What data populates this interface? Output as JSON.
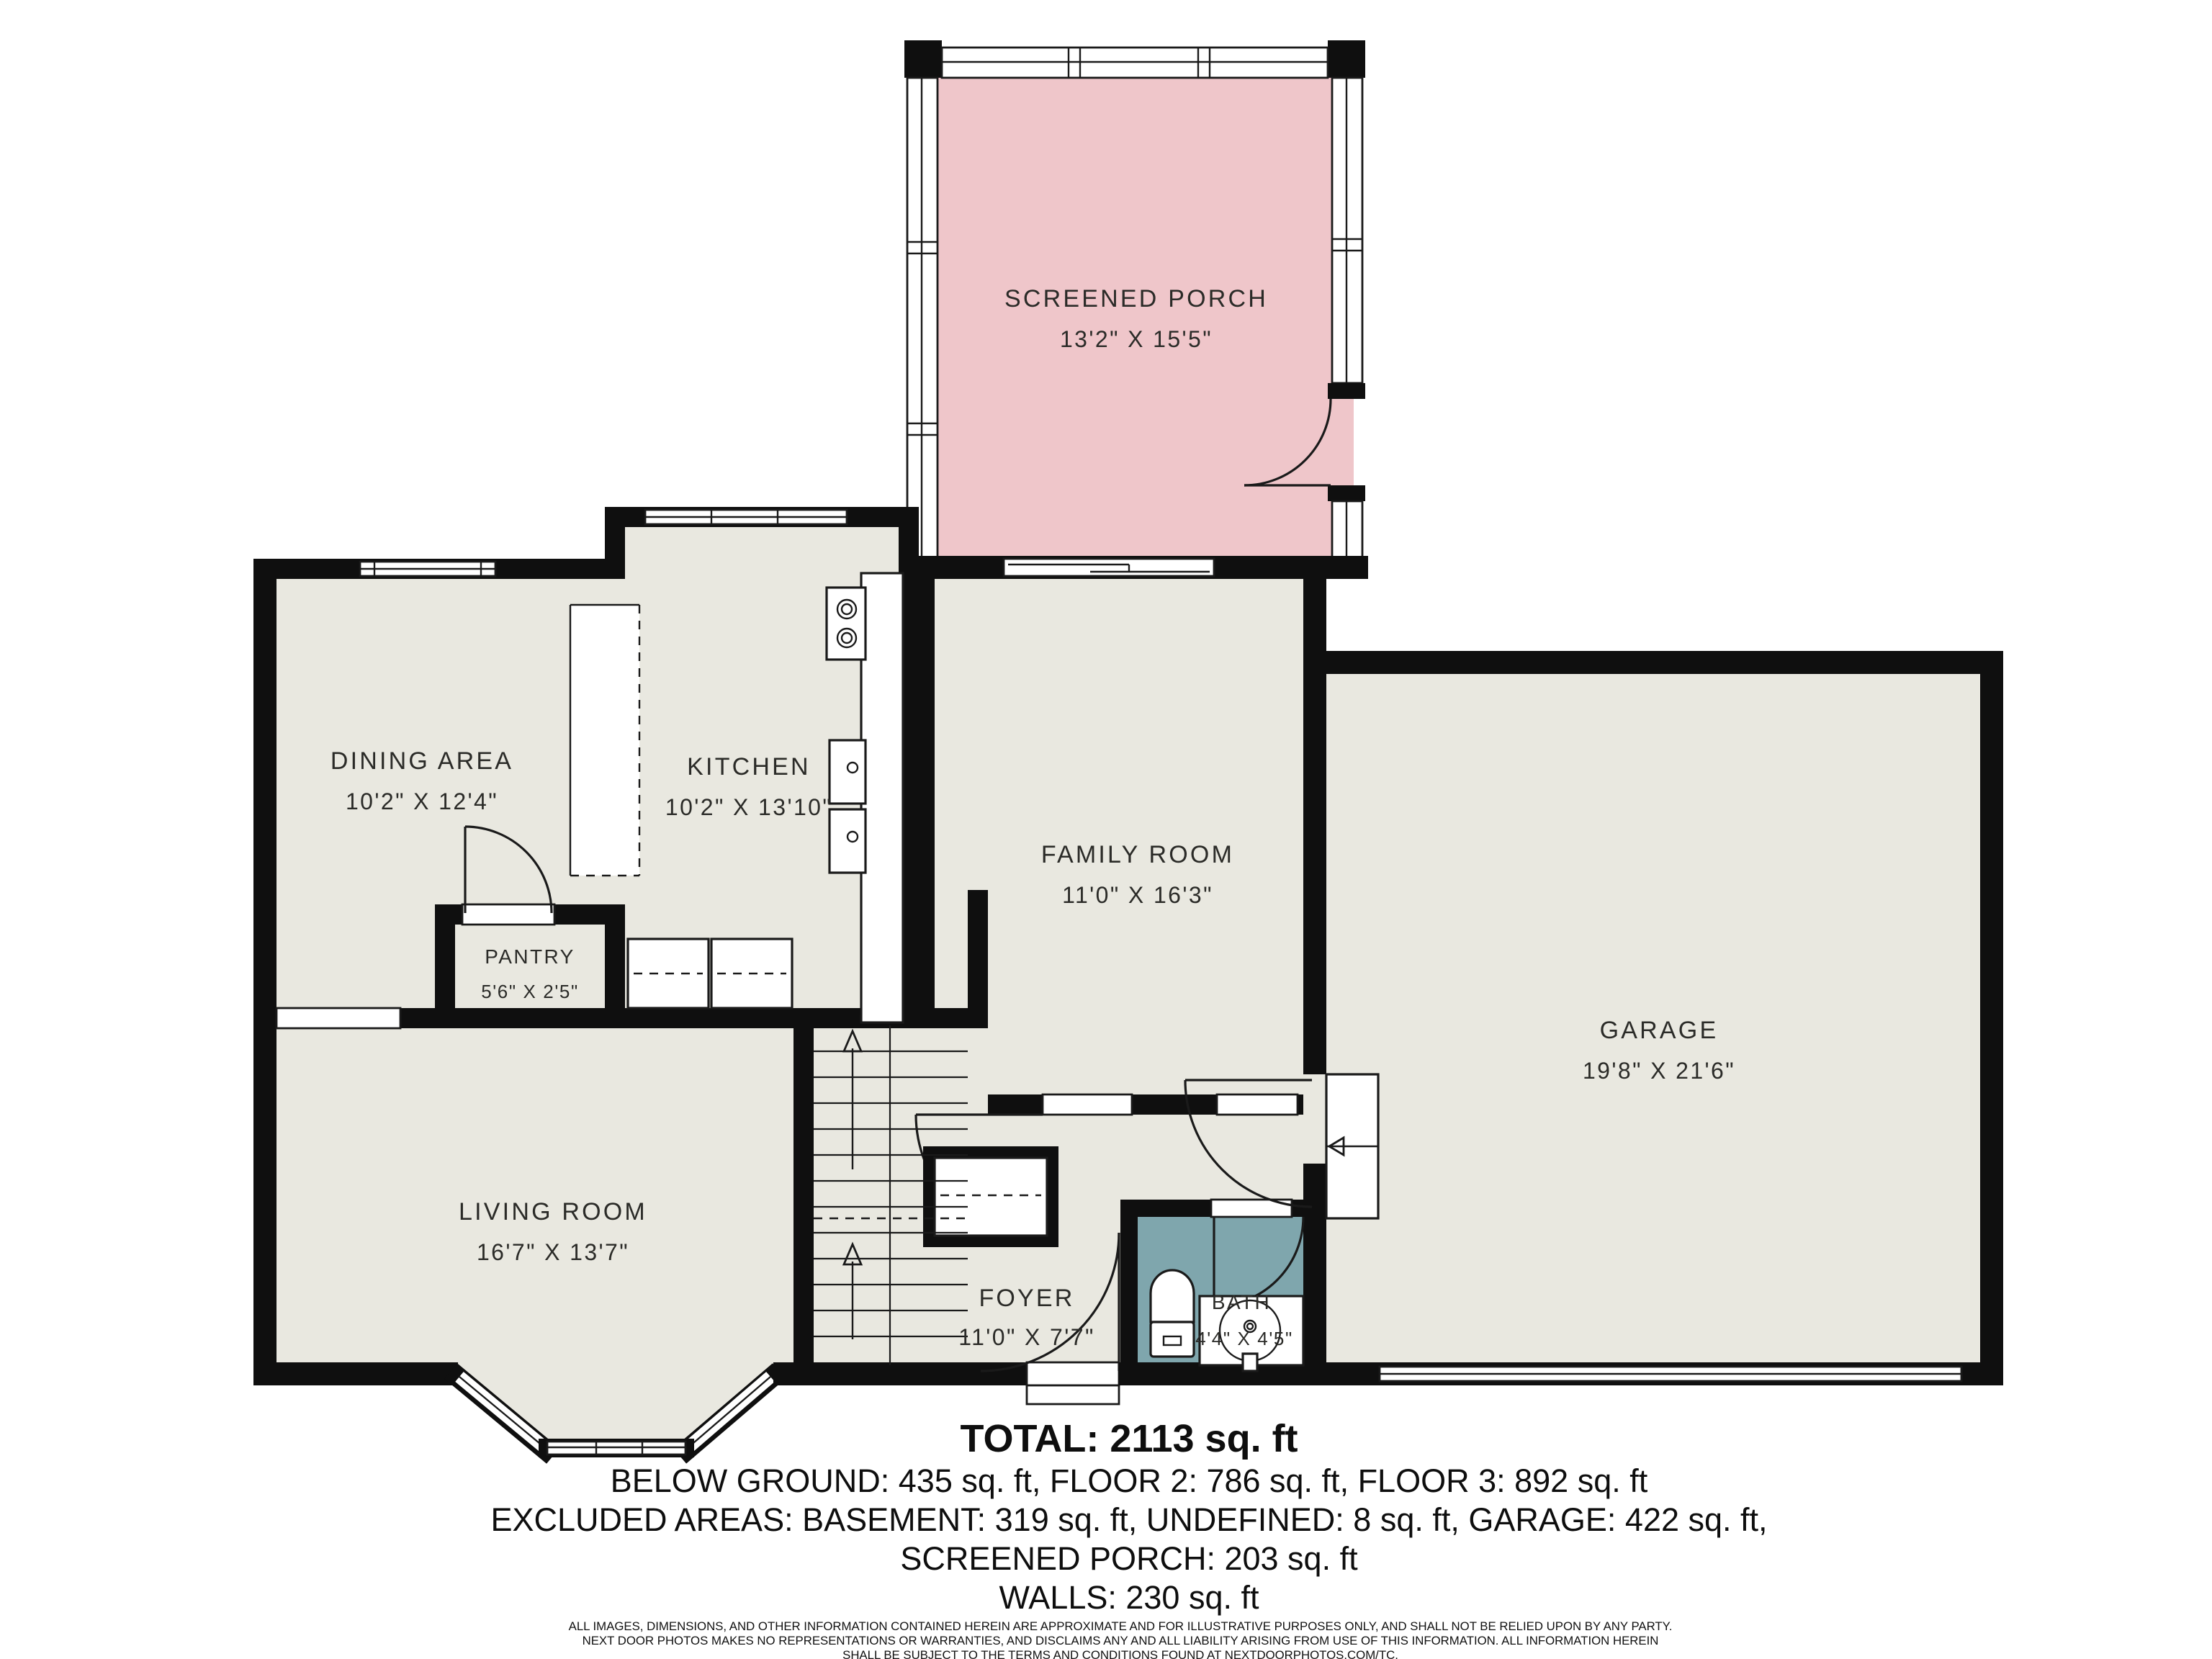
{
  "plan": {
    "type": "floor-plan",
    "rooms": [
      {
        "id": "screened_porch",
        "name": "SCREENED PORCH",
        "dims": "13'2\" X 15'5\""
      },
      {
        "id": "dining_area",
        "name": "DINING AREA",
        "dims": "10'2\" X 12'4\""
      },
      {
        "id": "kitchen",
        "name": "KITCHEN",
        "dims": "10'2\" X 13'10\""
      },
      {
        "id": "family_room",
        "name": "FAMILY ROOM",
        "dims": "11'0\" X 16'3\""
      },
      {
        "id": "pantry",
        "name": "PANTRY",
        "dims": "5'6\" X 2'5\""
      },
      {
        "id": "living_room",
        "name": "LIVING ROOM",
        "dims": "16'7\" X 13'7\""
      },
      {
        "id": "foyer",
        "name": "FOYER",
        "dims": "11'0\" X 7'7\""
      },
      {
        "id": "bath",
        "name": "BATH",
        "dims": "4'4\" X 4'5\""
      },
      {
        "id": "garage",
        "name": "GARAGE",
        "dims": "19'8\" X 21'6\""
      }
    ],
    "colors": {
      "floor": "#e9e8e0",
      "porch": "#efc6ca",
      "bath": "#7fa6ad",
      "wall": "#0f0f0f",
      "background": "#ffffff"
    }
  },
  "summary": {
    "total": "TOTAL: 2113 sq. ft",
    "floors": "BELOW GROUND: 435 sq. ft, FLOOR 2: 786 sq. ft, FLOOR 3: 892 sq. ft",
    "excluded_1": "EXCLUDED AREAS: BASEMENT: 319 sq. ft, UNDEFINED: 8 sq. ft, GARAGE: 422 sq. ft,",
    "excluded_2": "SCREENED PORCH: 203 sq. ft",
    "walls": "WALLS: 230 sq. ft"
  },
  "disclaimer": {
    "line1": "ALL IMAGES, DIMENSIONS, AND OTHER INFORMATION CONTAINED HEREIN ARE APPROXIMATE AND FOR ILLUSTRATIVE PURPOSES ONLY, AND SHALL NOT BE RELIED UPON BY ANY PARTY.",
    "line2": "NEXT DOOR PHOTOS MAKES NO REPRESENTATIONS OR WARRANTIES, AND DISCLAIMS ANY AND ALL LIABILITY ARISING FROM USE OF THIS INFORMATION. ALL INFORMATION HEREIN",
    "line3": "SHALL BE SUBJECT TO THE TERMS AND CONDITIONS FOUND AT NEXTDOORPHOTOS.COM/TC."
  }
}
